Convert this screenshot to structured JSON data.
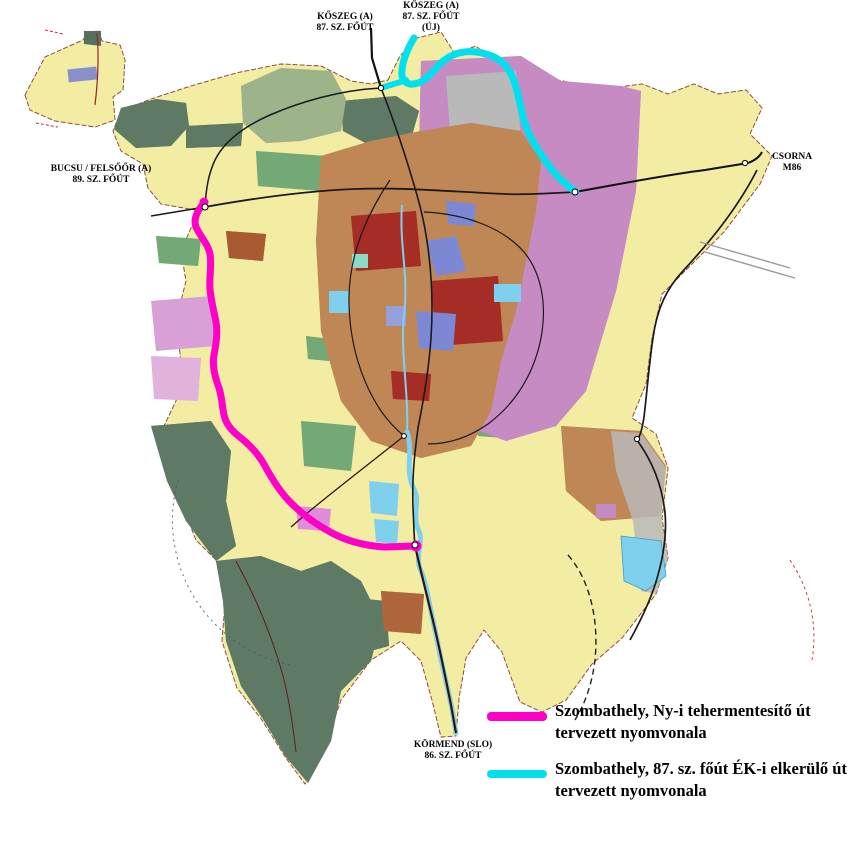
{
  "map_labels": {
    "koszeg_old": {
      "line1": "KŐSZEG (A)",
      "line2": "87. SZ. FŐÚT"
    },
    "koszeg_new": {
      "line1": "KŐSZEG (A)",
      "line2": "87. SZ. FŐÚT",
      "line3": "(ÚJ)"
    },
    "bucsu": {
      "line1": "BUCSU / FELSŐŐR (A)",
      "line2": "89. SZ. FŐÚT"
    },
    "csorna": {
      "line1": "CSORNA",
      "line2": "M86"
    },
    "kormend": {
      "line1": "KÖRMEND (SLO)",
      "line2": "86. SZ. FŐÚT"
    }
  },
  "routes": {
    "west_relief": {
      "color": "#FF00C8"
    },
    "ne_bypass": {
      "color": "#00E0EE"
    }
  },
  "legend": {
    "items": [
      {
        "swatch_color": "#FF00C8",
        "line1": "Szombathely, Ny-i tehermentesítő út",
        "line2": "tervezett nyomvonala"
      },
      {
        "swatch_color": "#00E0EE",
        "line1": "Szombathely, 87. sz. főút ÉK-i elkerülő út",
        "line2": "tervezett nyomvonala"
      }
    ]
  },
  "zone_palette": {
    "farmland_yellow": "#F2EDA2",
    "residential_purple": "#C78BC4",
    "forest_green": "#5E7A64",
    "sage_green": "#9DB48B",
    "park_green": "#74A877",
    "urban_brown": "#C08756",
    "dense_red": "#A62D26",
    "water_blue": "#7FD0EC",
    "periwinkle": "#7D88D4",
    "plum": "#D9A0D8",
    "gray_zone": "#B9B9B9"
  }
}
